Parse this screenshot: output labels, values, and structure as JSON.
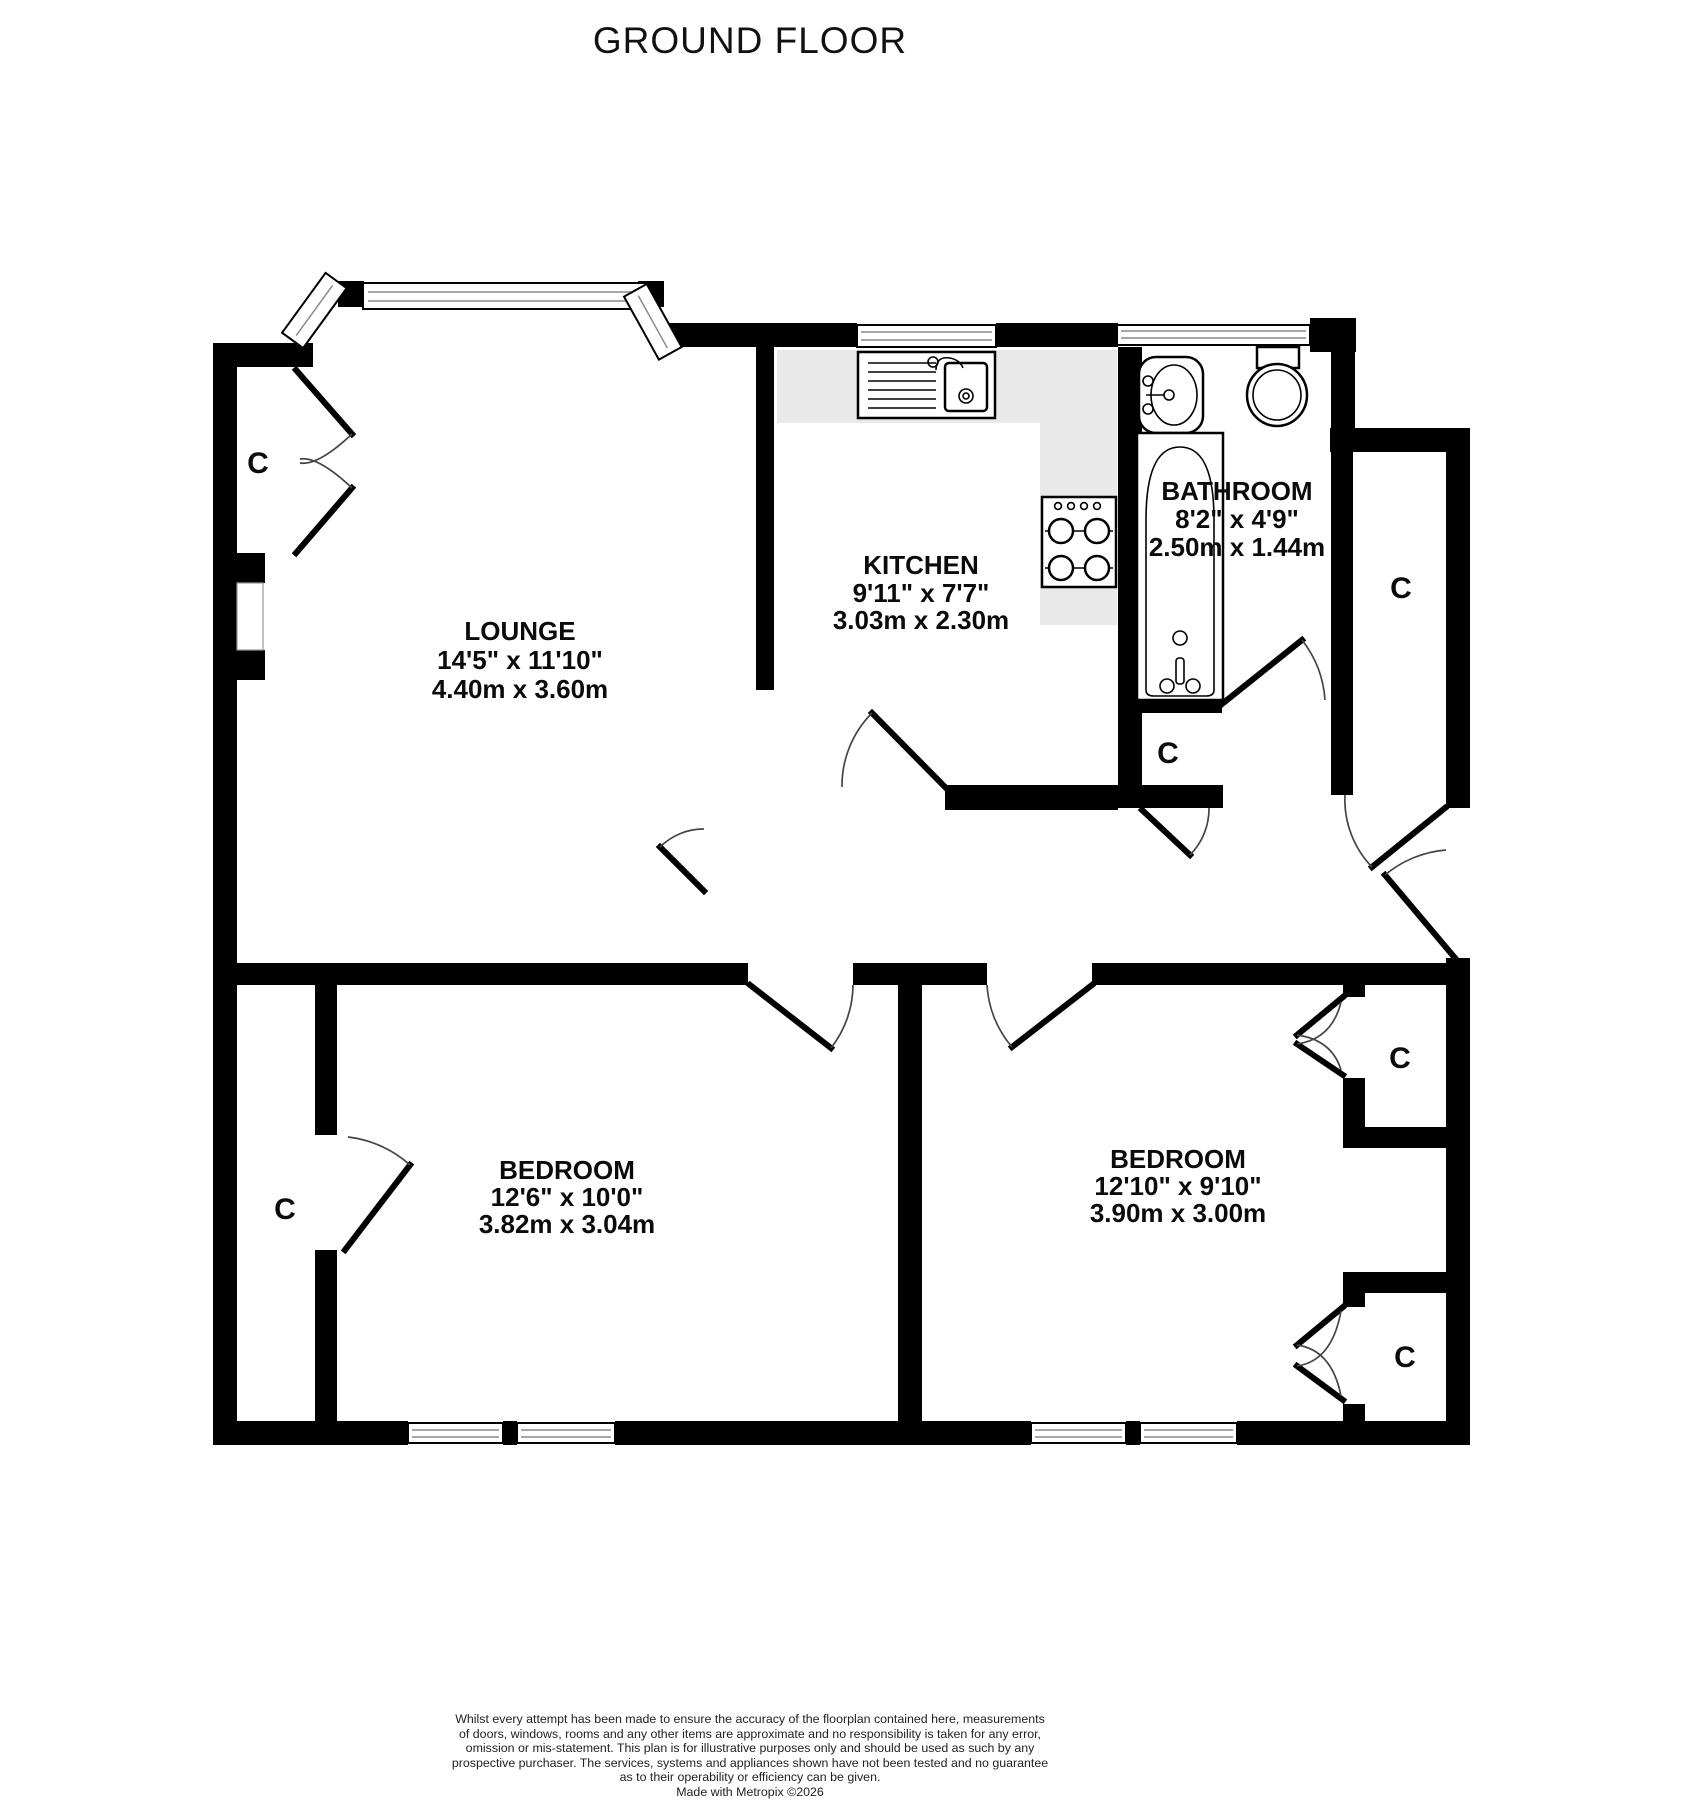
{
  "title": "GROUND FLOOR",
  "closet_label": "C",
  "colors": {
    "wall": "#000000",
    "counter": "#e9e9e9",
    "door_arc": "#454545",
    "text": "#0b0b0b"
  },
  "rooms": {
    "lounge": {
      "name": "LOUNGE",
      "imperial": "14'5\" x 11'10\"",
      "metric": "4.40m x 3.60m"
    },
    "kitchen": {
      "name": "KITCHEN",
      "imperial": "9'11\" x 7'7\"",
      "metric": "3.03m x 2.30m"
    },
    "bathroom": {
      "name": "BATHROOM",
      "imperial": "8'2\" x 4'9\"",
      "metric": "2.50m x 1.44m"
    },
    "bedroom1": {
      "name": "BEDROOM",
      "imperial": "12'6\" x 10'0\"",
      "metric": "3.82m x 3.04m"
    },
    "bedroom2": {
      "name": "BEDROOM",
      "imperial": "12'10\" x 9'10\"",
      "metric": "3.90m x 3.00m"
    }
  },
  "footer": {
    "disclaimer_lines": [
      "Whilst every attempt has been made to ensure the accuracy of the floorplan contained here, measurements",
      "of doors, windows, rooms and any other items are approximate and no responsibility is taken for any error,",
      "omission or mis-statement. This plan is for illustrative purposes only and should be used as such by any",
      "prospective purchaser. The services, systems and appliances shown have not been tested and no guarantee",
      "as to their operability or efficiency can be given."
    ],
    "credit": "Made with Metropix ©2026"
  }
}
